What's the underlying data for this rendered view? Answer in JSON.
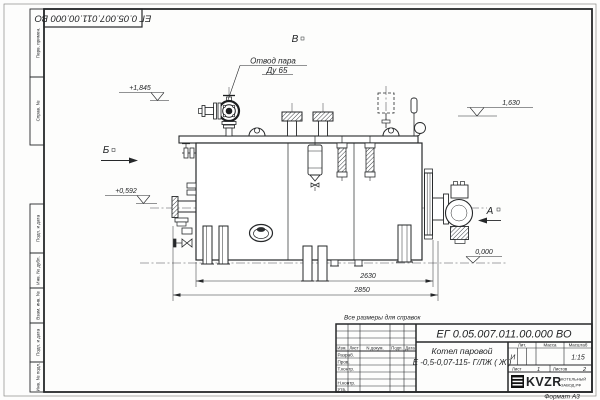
{
  "colors": {
    "line": "#26282a",
    "sheet": "#fdfdfc",
    "logo_black": "#111111"
  },
  "margins": {
    "cells": [
      "Перв. примен.",
      "Справ. №",
      "Подп. и дата",
      "Инв. № дубл.",
      "Взам. инв. №",
      "Подп. и дата",
      "Инв. № подл."
    ],
    "top_stamp": "ЕГ 0.05.007.011.00.000  ВО",
    "format_note": "Формат А3"
  },
  "drawing": {
    "note": "Все размеры для справок",
    "labels": {
      "steam_outlet_1": "Отвод пара",
      "steam_outlet_2": "Ду 65",
      "view_top": "В",
      "view_left": "Б",
      "view_right": "А"
    },
    "elevations": {
      "valve_top": "+1,845",
      "left_lower": "+0,592",
      "right_upper": "1,630",
      "ground": "0,000"
    },
    "dimensions": {
      "inner": "2630",
      "outer": "2850"
    }
  },
  "title_block": {
    "designation": "ЕГ 0.05.007.011.00.000  ВО",
    "name_line1": "Котел паровой",
    "name_line2": "Е -0,5-0,07-115- Г/ЛЖ ( Ж )",
    "columns": [
      "Изм.",
      "Лист",
      "N докум.",
      "Подп.",
      "Дата"
    ],
    "roles": [
      "Разраб.",
      "Пров.",
      "Т.контр.",
      "Н.контр.",
      "Утв."
    ],
    "lit_label": "Лит.",
    "lit_value": "И",
    "mass_label": "Масса",
    "scale_label": "Масштаб",
    "scale_value": "1:15",
    "sheet_label": "Лист",
    "sheet_no": "1",
    "sheets_label": "Листов",
    "sheets_total": "2",
    "logo_text": "KVZR",
    "logo_sub1": "КОТЕЛЬНЫЙ",
    "logo_sub2": "ЗАВОД.РФ"
  }
}
